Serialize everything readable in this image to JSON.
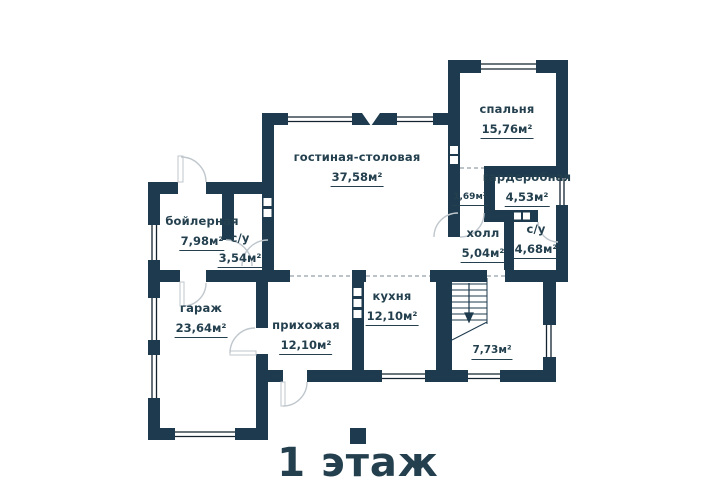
{
  "title": "1 этаж",
  "colors": {
    "wall": "#1d3a4e",
    "text": "#24404f",
    "frame": "#13232f",
    "door": "#bfc7cd",
    "dash": "#93a0a9",
    "bg": "#ffffff"
  },
  "rooms": [
    {
      "id": "living-dining",
      "name": "гостиная-столовая",
      "area": "37,58м²"
    },
    {
      "id": "bedroom",
      "name": "спальня",
      "area": "15,76м²"
    },
    {
      "id": "wardrobe",
      "name": "гардеробная",
      "area": "4,53м²"
    },
    {
      "id": "corridor",
      "name": "",
      "area": "1,69м²"
    },
    {
      "id": "hall",
      "name": "холл",
      "area": "5,04м²"
    },
    {
      "id": "bathroom-top",
      "name": "с/у",
      "area": "4,68м²"
    },
    {
      "id": "boiler-room",
      "name": "бойлерная",
      "area": "7,98м²"
    },
    {
      "id": "bathroom-left",
      "name": "с/у",
      "area": "3,54м²"
    },
    {
      "id": "garage",
      "name": "гараж",
      "area": "23,64м²"
    },
    {
      "id": "entry-hall",
      "name": "прихожая",
      "area": "12,10м²"
    },
    {
      "id": "kitchen",
      "name": "кухня",
      "area": "12,10м²"
    },
    {
      "id": "stairs-room",
      "name": "",
      "area": "7,73м²"
    }
  ]
}
